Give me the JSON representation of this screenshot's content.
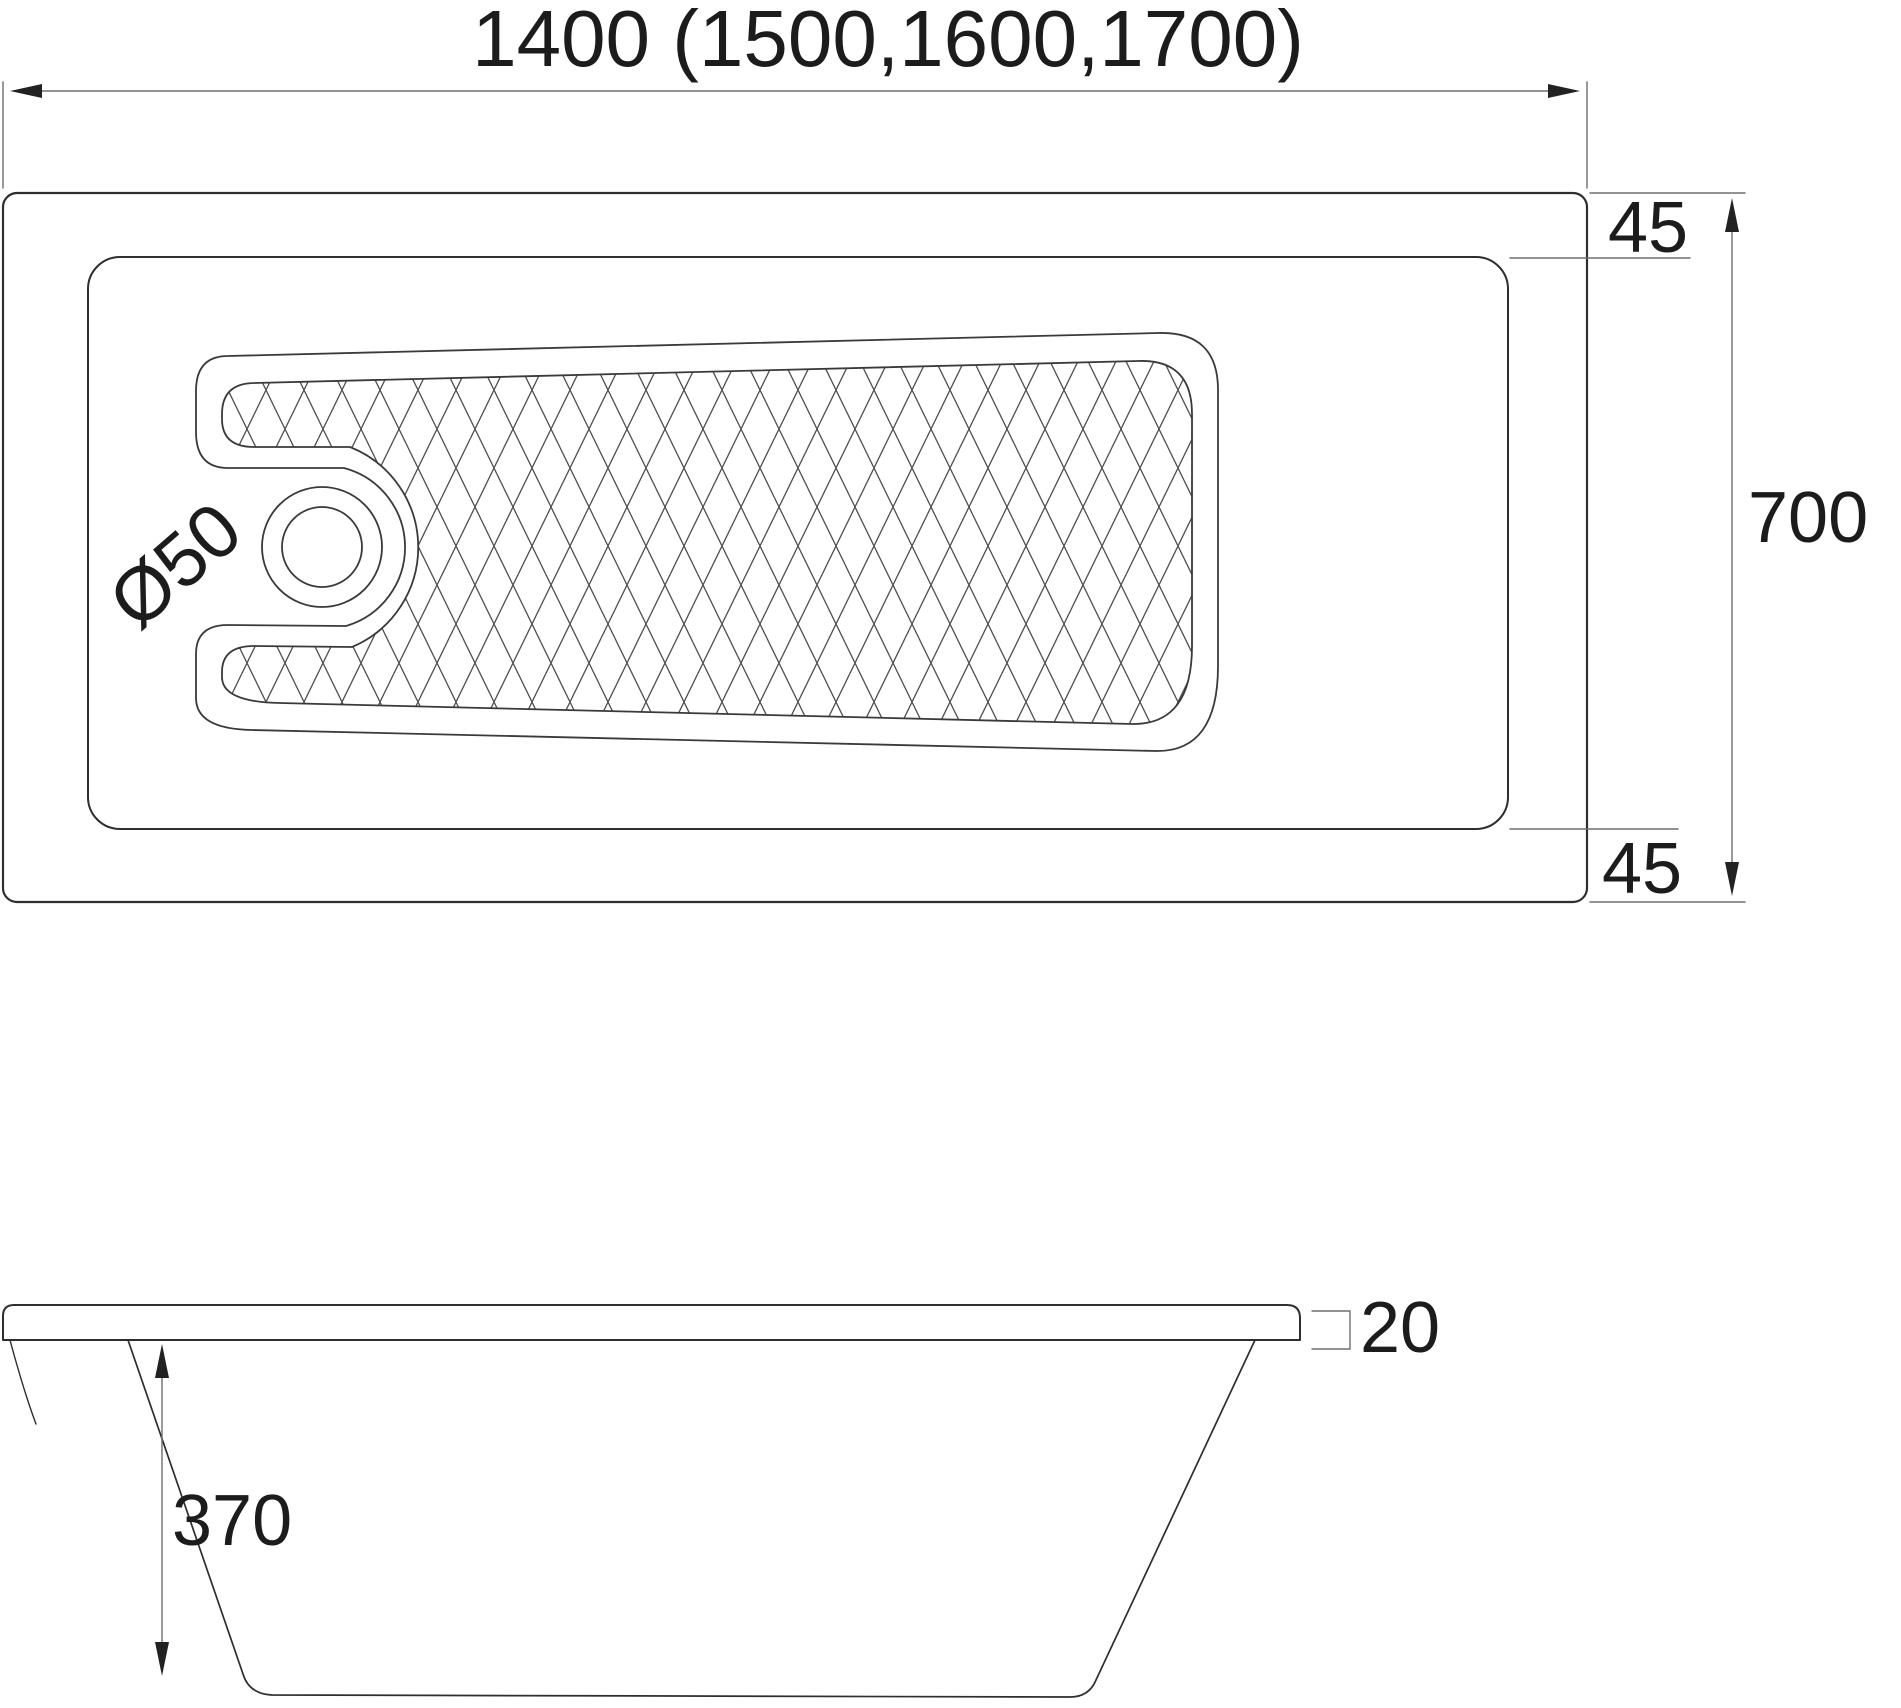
{
  "top_view": {
    "length_label": "1400 (1500,1600,1700)",
    "width_label": "700",
    "rim_top_label": "45",
    "rim_bottom_label": "45",
    "drain_label": "Ø50"
  },
  "side_view": {
    "depth_label": "370",
    "rim_thickness_label": "20"
  },
  "style": {
    "background": "#ffffff",
    "line_color": "#2e2e2e",
    "thin_line_color": "#3a3a3a",
    "dim_color": "#6e6e6e",
    "hatch_color": "#4f4f4f",
    "arrow_color": "#222222"
  }
}
